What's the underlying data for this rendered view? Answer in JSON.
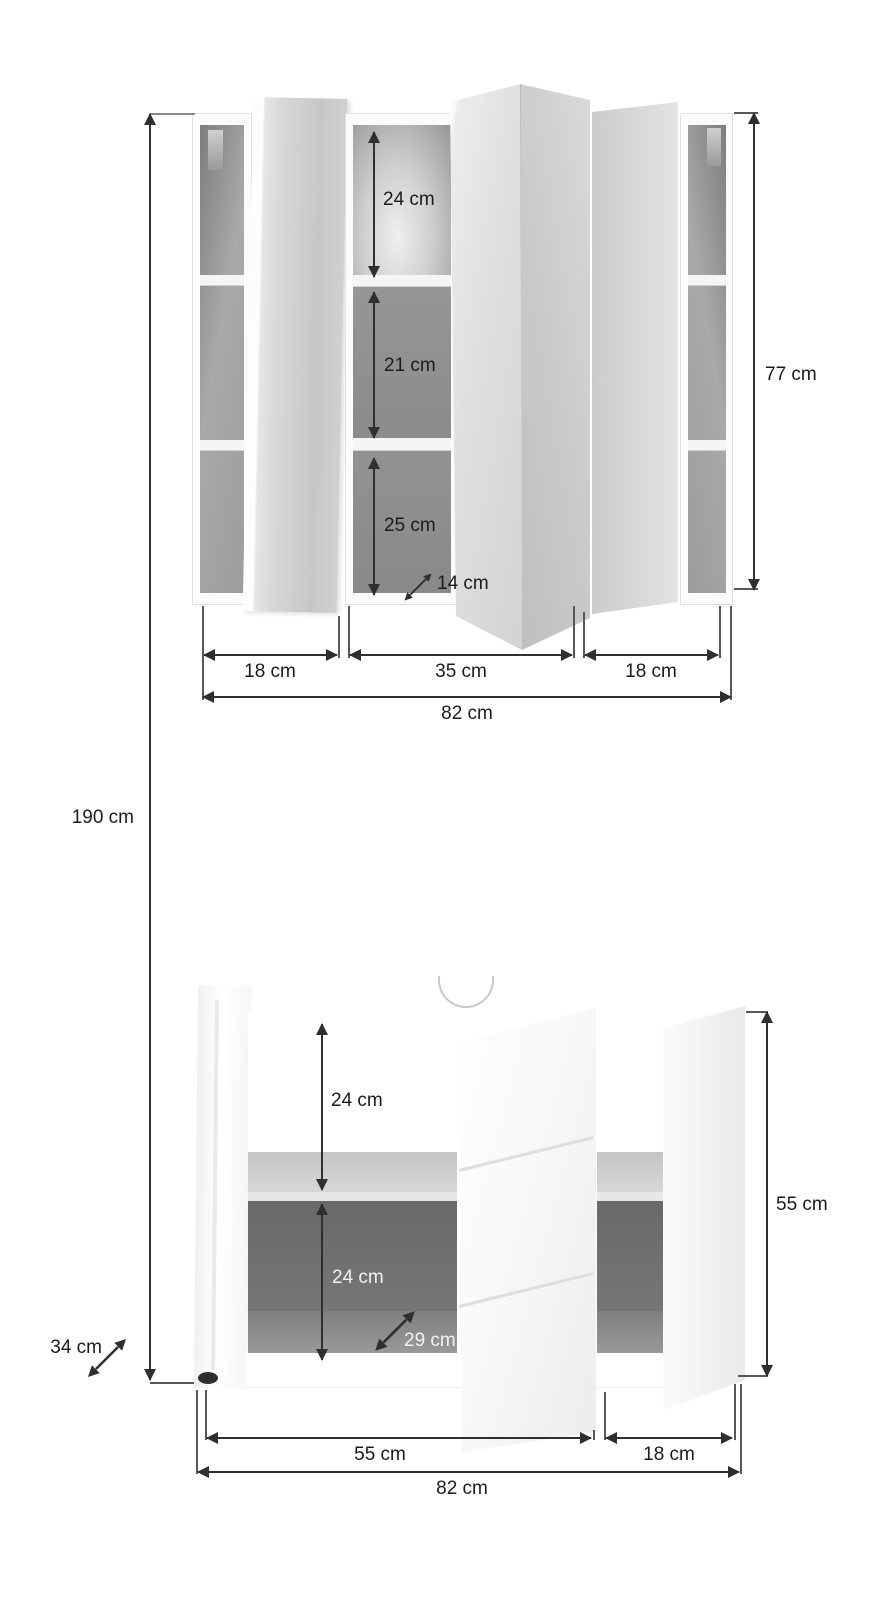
{
  "unit": "cm",
  "total_height_label": "190 cm",
  "mirror_cabinet": {
    "compartments": [
      "24 cm",
      "21 cm",
      "25 cm"
    ],
    "depth_label": "14 cm",
    "sections": [
      "18 cm",
      "35 cm",
      "18 cm"
    ],
    "width_label": "82 cm",
    "height_label": "77 cm"
  },
  "vanity_cabinet": {
    "compartments": [
      "24 cm",
      "24 cm"
    ],
    "depth_label": "29 cm",
    "sections": [
      "55 cm",
      "18 cm"
    ],
    "width_label": "82 cm",
    "height_label": "55 cm",
    "body_depth_label": "34 cm"
  },
  "colors": {
    "dimension_line": "#2f2f2f",
    "interior_gray": "#8f8f8f",
    "dark_interior": "#6b6b6b",
    "shelf_light": "#cdcdcd",
    "cabinet_white": "#fbfbfa"
  }
}
